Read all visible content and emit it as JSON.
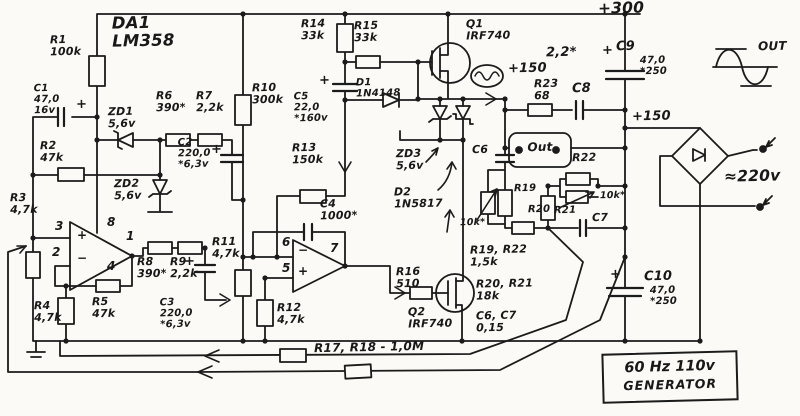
{
  "ic": "DA1\nLM358",
  "power": {
    "v300": "+300",
    "v150_top": "+150",
    "v150_rail": "+150",
    "ac": "≈220v"
  },
  "labels": {
    "r1": "R1\n100k",
    "c1": "C1\n47,0\n16v",
    "zd1": "ZD1\n5,6v",
    "r6": "R6\n390*",
    "r7": "R7\n2,2k",
    "r2": "R2\n47k",
    "zd2": "ZD2\n5,6v",
    "c2": "C2\n220,0\n*6,3v",
    "r3": "R3\n4,7k",
    "r4": "R4\n4,7k",
    "r5": "R5\n47k",
    "r8": "R8\n390*",
    "r9": "R9\n2,2k",
    "c3": "C3\n220,0\n*6,3v",
    "r10": "R10\n300k",
    "r11": "R11\n4,7k",
    "r12": "R12\n4,7k",
    "r13": "R13\n150k",
    "r14": "R14\n33k",
    "r15": "R15\n33k",
    "c5": "C5\n22,0\n*160v",
    "d1": "D1\n1N4148",
    "c4": "C4\n1000*",
    "zd3": "ZD3\n5,6v",
    "d2": "D2\n1N5817",
    "r16": "R16\n510",
    "q1": "Q1\nIRF740",
    "q2": "Q2\nIRF740",
    "r23": "R23\n68",
    "c8": "C8",
    "c8_val": "2,2*",
    "c9": "C9",
    "c9_val": "47,0\n*250",
    "c10": "C10",
    "c10_val": "47,0\n*250",
    "c6": "C6",
    "c7": "C7",
    "r19": "R19",
    "r20": "R20",
    "r21": "R21",
    "r22": "R22",
    "trim1": "10k*",
    "trim2": "10k*",
    "r19_r22": "R19, R22\n1,5k",
    "r20_r21": "R20, R21\n18k",
    "c6_c7": "C6, C7\n0,15",
    "r17_r18": "R17, R18 - 1,0M",
    "out_box": "Out",
    "out_wave": "OUT",
    "plus": "+"
  },
  "opamp1": {
    "pin3": "3",
    "pin2": "2",
    "pin8": "8",
    "pin1": "1",
    "pin4": "4",
    "plus": "+",
    "minus": "−"
  },
  "opamp2": {
    "pin6": "6",
    "pin5": "5",
    "pin7": "7",
    "plus": "+",
    "minus": "−"
  },
  "genbox": {
    "line1": "60 Hz 110v",
    "line2": "GENERATOR"
  }
}
